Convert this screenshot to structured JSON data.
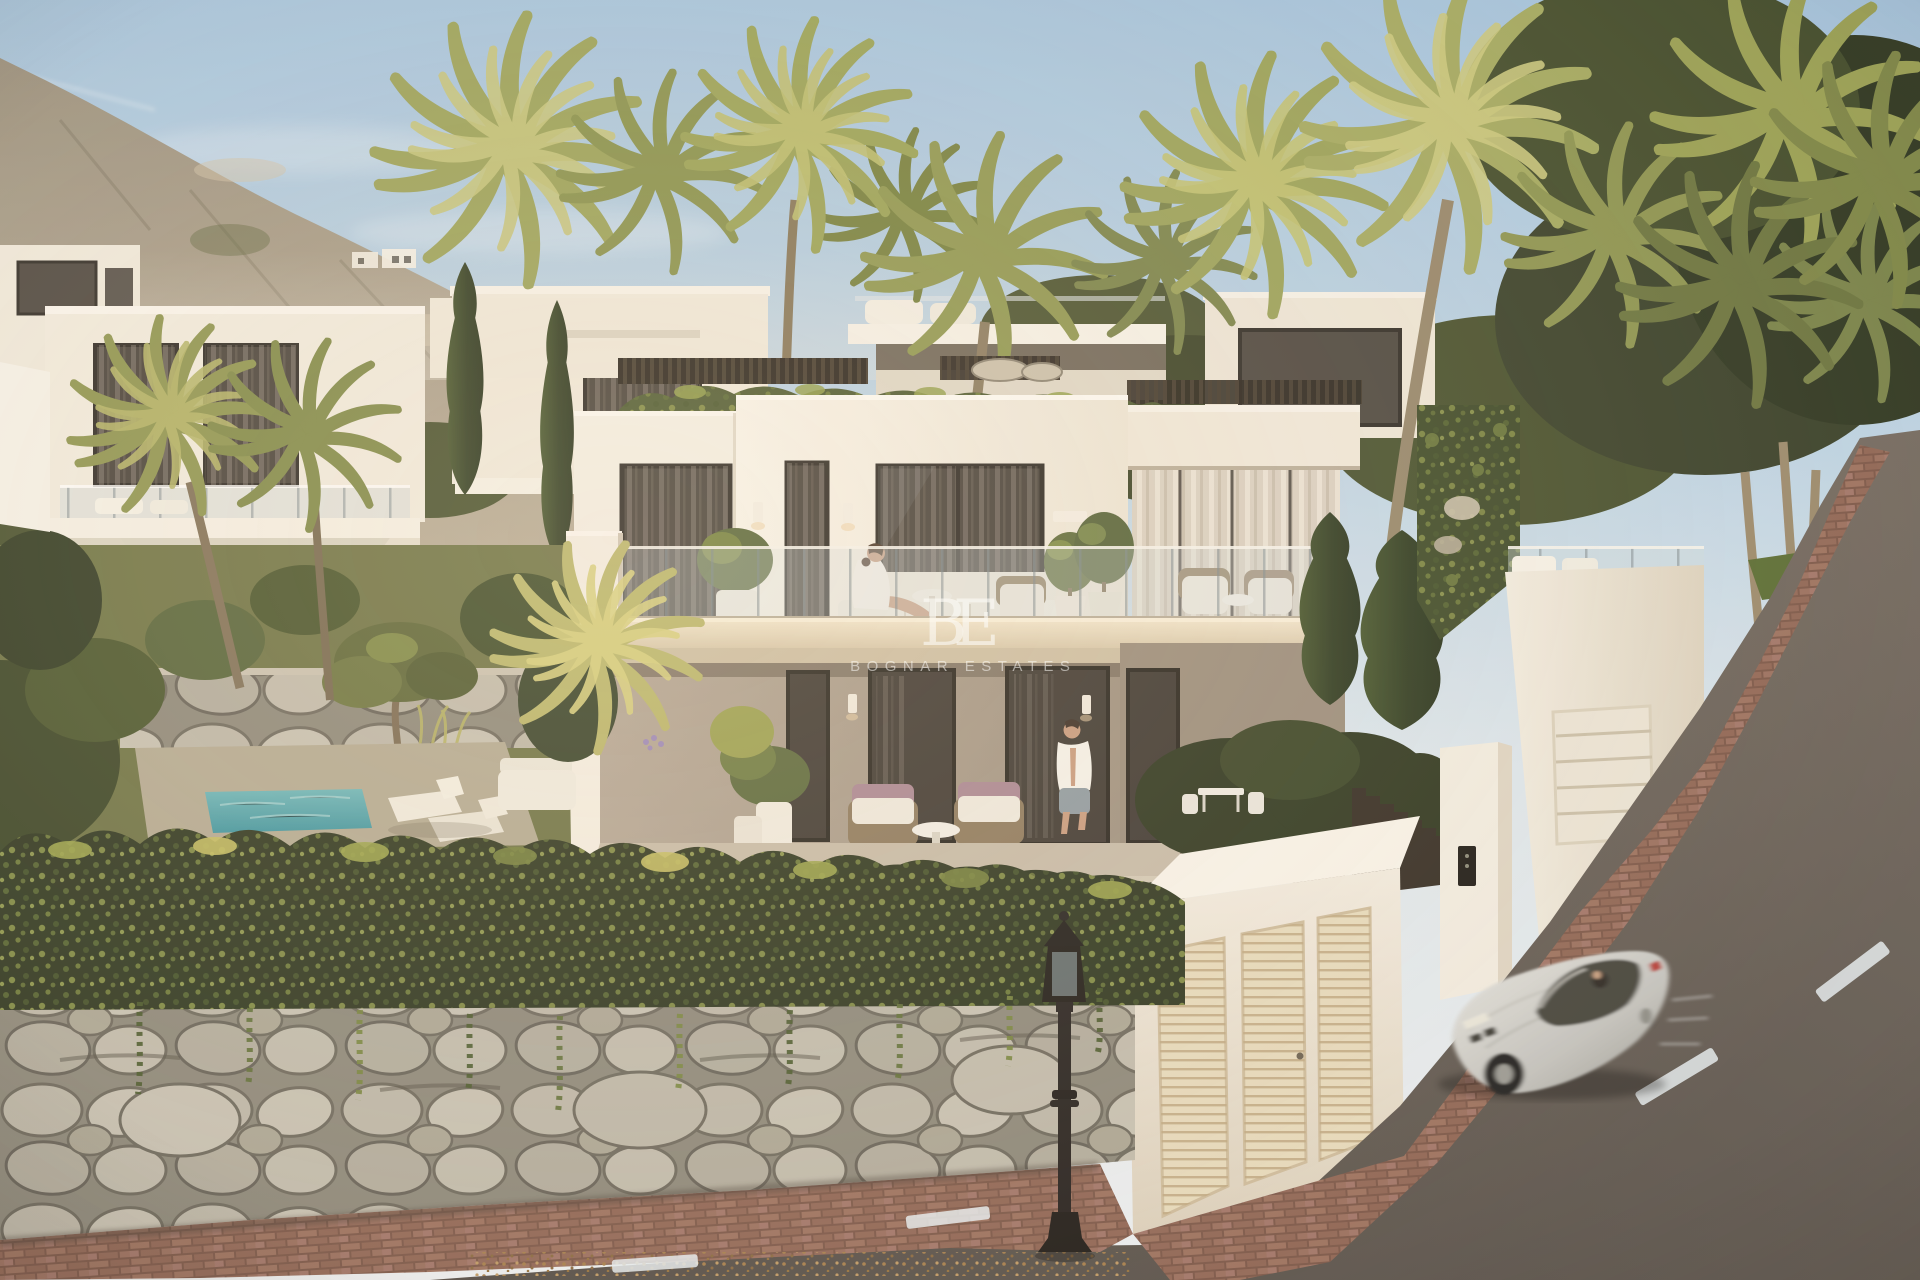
{
  "watermark": {
    "monogram": "BE",
    "wordmark": "BOGNAR ESTATES"
  },
  "scene": {
    "type": "architectural-exterior-rendering",
    "setting": "Terraced hillside development of modern white villas at golden hour, Mediterranean mountain backdrop",
    "objects": [
      "hazy blue sky",
      "rocky mountain ridge",
      "rows of white flat-roof villas",
      "palm trees",
      "cypress trees",
      "ivy-clad stone retaining walls",
      "plunge pool with sun loungers",
      "upper terrace with glass balustrade",
      "lower covered terrace with lounge chairs",
      "potted olive trees",
      "white gate block with louvred panels",
      "dark slatted fences",
      "intercom pillar",
      "classic black street lamp",
      "brick-paved curved sidewalk",
      "asphalt road with dashed centre line",
      "silver sports coupe in motion"
    ],
    "people": [
      "woman in white robe reclining on upper-terrace sofa",
      "man in open white shirt and grey shorts walking on lower terrace"
    ],
    "vehicle": "silver sports coupe, motion-blurred, driving downhill"
  },
  "palette": {
    "sky_top": "#a4c3dd",
    "sky_horizon": "#e9eef1",
    "mountain": "#a89e8b",
    "villa_white": "#f4f0e7",
    "villa_shadow": "#b1a495",
    "terrace_slab": "#e0d2b8",
    "window_dark": "#46413b",
    "foliage_dark": "#3c4527",
    "foliage_light": "#9aa355",
    "palm_lit": "#c6c67e",
    "stone": "#b7b2a4",
    "brick_sidewalk": "#96705f",
    "road_asphalt": "#5f5954",
    "pool_water": "#57a5ae",
    "car_silver": "#cfcfcb",
    "lamppost": "#262220",
    "gate_cream": "#e6dabd",
    "fence_dark": "#332c24",
    "watermark_white": "rgba(252,250,246,0.6)"
  }
}
